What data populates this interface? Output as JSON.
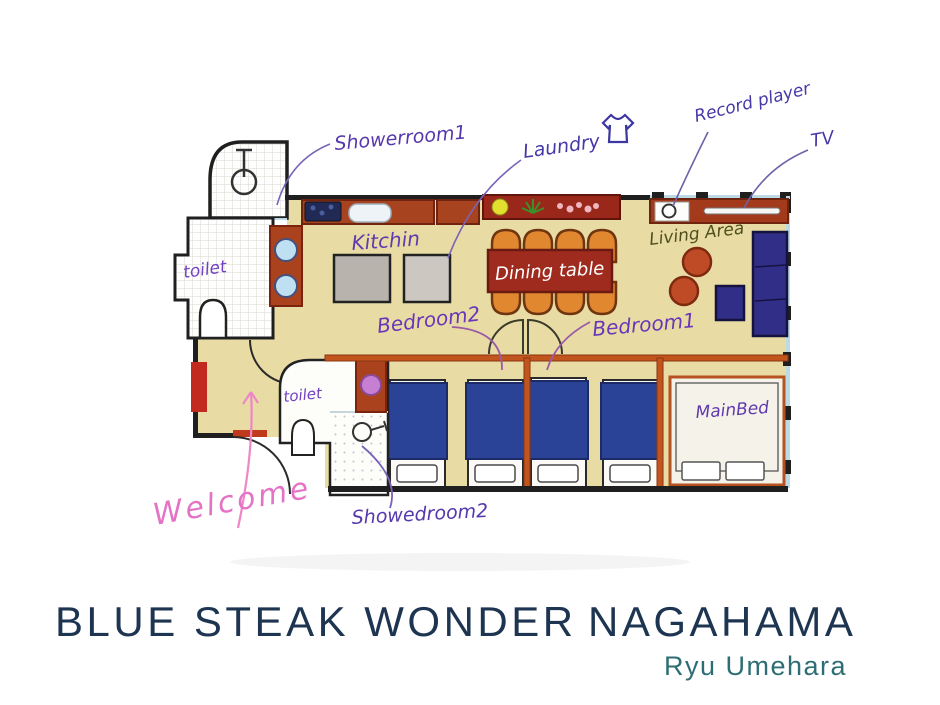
{
  "floor_plan": {
    "annotations": {
      "showerroom1": "Showerroom1",
      "laundry": "Laundry",
      "record_player": "Record player",
      "tv": "TV",
      "kitchen": "Kitchin",
      "dining_table": "Dining table",
      "living_area": "Living Area",
      "toilet_upper": "toilet",
      "toilet_lower": "toilet",
      "bedroom2": "Bedroom2",
      "bedroom1": "Bedroom1",
      "main_bed": "MainBed",
      "showedroom2": "Showedroom2",
      "welcome": "Welcome"
    },
    "colors": {
      "floor_beige": "#e8dca4",
      "wall_black": "#1f1f1f",
      "bedroom_wall_orange": "#c2551e",
      "counter_red": "#a84320",
      "dining_table_red": "#9e2b1e",
      "chair_orange": "#e0872f",
      "bed_blanket_blue": "#2a4396",
      "sofa_indigo": "#312e88",
      "window_blue": "#bcdae6",
      "ink_purple": "#6039ae",
      "ink_pink": "#e573c5",
      "ink_olive": "#4f4e1d",
      "title_navy": "#1e3552",
      "author_teal": "#2d6e75"
    }
  },
  "footer": {
    "title_main": "BLUE STEAK WONDER",
    "title_location": "NAGAHAMA",
    "author": "Ryu Umehara"
  }
}
